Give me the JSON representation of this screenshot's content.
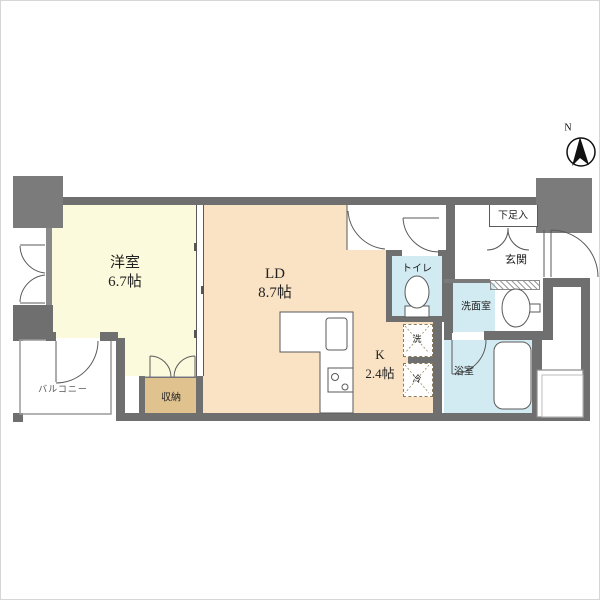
{
  "plan": {
    "rooms": {
      "western_room": {
        "label": "洋室",
        "size": "6.7帖"
      },
      "living_dining": {
        "label": "LD",
        "size": "8.7帖"
      },
      "kitchen": {
        "label": "K",
        "size": "2.4帖"
      },
      "toilet": {
        "label": "トイレ"
      },
      "washroom": {
        "label": "洗面室"
      },
      "bathroom": {
        "label": "浴室"
      },
      "entrance": {
        "label": "玄関"
      },
      "shoe_cabinet": {
        "label": "下足入"
      },
      "closet": {
        "label": "収納"
      },
      "balcony": {
        "label": "バルコニー"
      },
      "washer_space": {
        "label": "洗"
      },
      "refrigerator_space": {
        "label": "冷"
      }
    },
    "compass": {
      "label": "N"
    },
    "colors": {
      "wall": "#6f6f6f",
      "western_room_floor": "#FCFADC",
      "living_dining_floor": "#FAE3C4",
      "wet_area_floor": "#D2EBF2",
      "closet_floor": "#E0C28F"
    }
  }
}
